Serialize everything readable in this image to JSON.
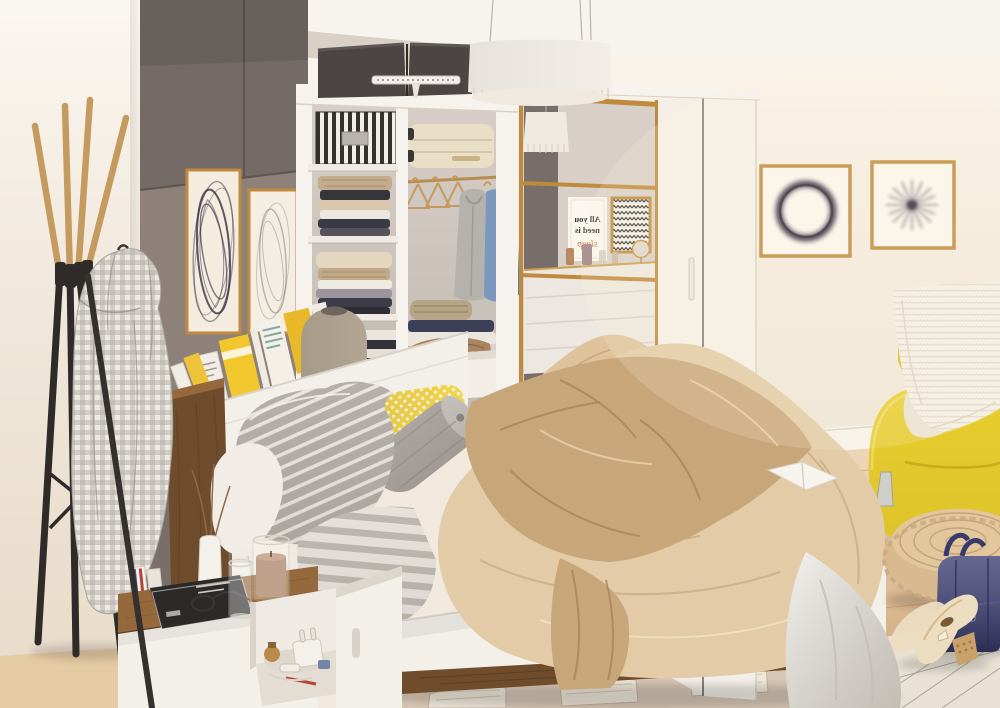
{
  "scene": {
    "alt": "Bright bedroom: storage bed with beige blankets and striped pillows, open white wardrobe with folded clothes, mirrored sliding wardrobe, coat rack with gingham jacket, nightstand with book and glasses, yellow armchair, rope pouf, navy handbag and cream heels on a patterned rug",
    "poster": {
      "line1": "All you",
      "line2": "need is",
      "line3": "sleep",
      "accent_color": "#c07a2e"
    },
    "objects": [
      "pendant lamp",
      "open wardrobe",
      "mirrored sliding wardrobe",
      "storage bed",
      "nightstand",
      "coat rack with jacket",
      "yellow armchair",
      "rope pouf",
      "navy handbag",
      "heeled shoes",
      "wall art"
    ]
  },
  "palette": {
    "ceiling": "#f7f4ef",
    "wall_left": "#f6eee3",
    "wall_right": "#f7efe3",
    "accent_wall": "#8d817a",
    "dark_cabinet": "#746b67",
    "wardrobe_white": "#f6f2ed",
    "wardrobe_interior": "#d7cfc7",
    "shelf_white": "#efeae3",
    "mirror_glass": "#d9d1c8",
    "sliding_door": "#f4efe8",
    "trim_gold": "#c08a3e",
    "floor_wood": "#e6c497",
    "walnut": "#6f4c2b",
    "walnut_light": "#96693c",
    "bed_white": "#f3efe9",
    "blanket_beige": "#e2cba6",
    "throw_tan": "#c7a67a",
    "pillow_gray": "#b4afa8",
    "runner_gray": "#e6e1da",
    "cushion_yellow": "#f1d44e",
    "sofa_yellow": "#e9ce2d",
    "bag_navy": "#3e4076",
    "pouf_rope": "#d9ba8f",
    "rug_beige": "#d8c7b5",
    "rug_light": "#eae3d7",
    "art_ink": "#2c2338",
    "lamp_shade": "#f2eee7",
    "lamp_taupe": "#b2a593",
    "shoe_cream": "#ecdcc0",
    "drape_gray": "#e7e3dc",
    "storage_box_dark": "#4b4644",
    "suitcase_cream": "#e9dec6"
  }
}
